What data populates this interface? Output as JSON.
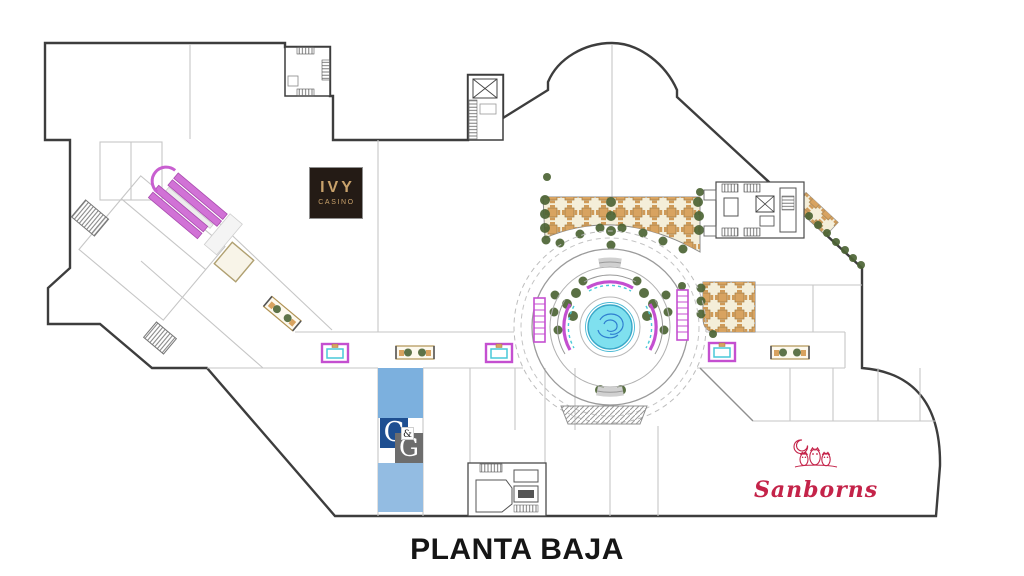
{
  "title": {
    "label": "PLANTA BAJA"
  },
  "stores": {
    "ivy_casino": {
      "name_line1": "IVY",
      "name_line2": "CASINO"
    },
    "c_and_g": {
      "letter_c": "C",
      "ampersand": "&",
      "letter_g": "G"
    },
    "sanborns": {
      "name": "Sanborns"
    }
  },
  "colors": {
    "outline": "#3d3d3d",
    "interior_line": "#c6c6c6",
    "magenta": "#c44fd0",
    "cyan_accent": "#49c9d8",
    "fountain_fill": "#7fe0ef",
    "terrace_bg": "#f4eed9",
    "table_tan": "#d8a360",
    "tree_green": "#4d6435",
    "highlight_unit_upper": "#7cb0de",
    "highlight_unit_lower": "#93bce2",
    "cg_blue": "#1e4f91",
    "cg_gray": "#6d6d6d",
    "ivy_bg": "#241b15",
    "ivy_gold": "#c9a26b",
    "sanborns_red": "#c42349"
  }
}
